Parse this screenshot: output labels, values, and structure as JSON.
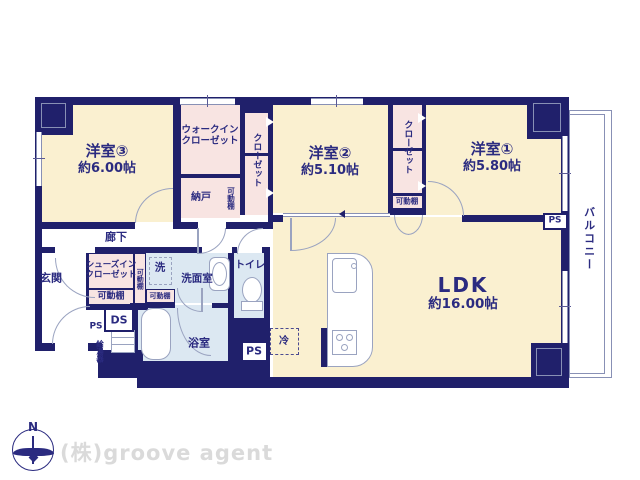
{
  "colors": {
    "wall": "#20206b",
    "room_cream": "#faf0d0",
    "closet_pink": "#f8e4e2",
    "wet_blue": "#dce8f2",
    "text": "#2b2b80",
    "line": "#9aa3c0",
    "watermark": "#dadada"
  },
  "rooms": {
    "bed3": {
      "name": "洋室③",
      "size": "約6.00帖"
    },
    "bed2": {
      "name": "洋室②",
      "size": "約5.10帖"
    },
    "bed1": {
      "name": "洋室①",
      "size": "約5.80帖"
    },
    "ldk": {
      "name": "LDK",
      "size": "約16.00帖"
    },
    "wic": {
      "name": "ウォークインクローゼット"
    },
    "closet": {
      "name": "クローゼット"
    },
    "nando": {
      "name": "納戸"
    },
    "shelf": {
      "name": "可動棚"
    },
    "corridor": {
      "name": "廊下"
    },
    "genkan": {
      "name": "玄関"
    },
    "sic": {
      "name": "シューズインクローゼット"
    },
    "laundry": {
      "name": "洗"
    },
    "washroom": {
      "name": "洗面室"
    },
    "toilet": {
      "name": "トイレ"
    },
    "bath": {
      "name": "浴室"
    },
    "balcony": {
      "name": "バルコニー"
    }
  },
  "labels": {
    "ds": "DS",
    "ps": "PS",
    "water_heater": "給湯器",
    "fridge": "冷",
    "north": "N"
  },
  "watermark": "(株)groove agent"
}
